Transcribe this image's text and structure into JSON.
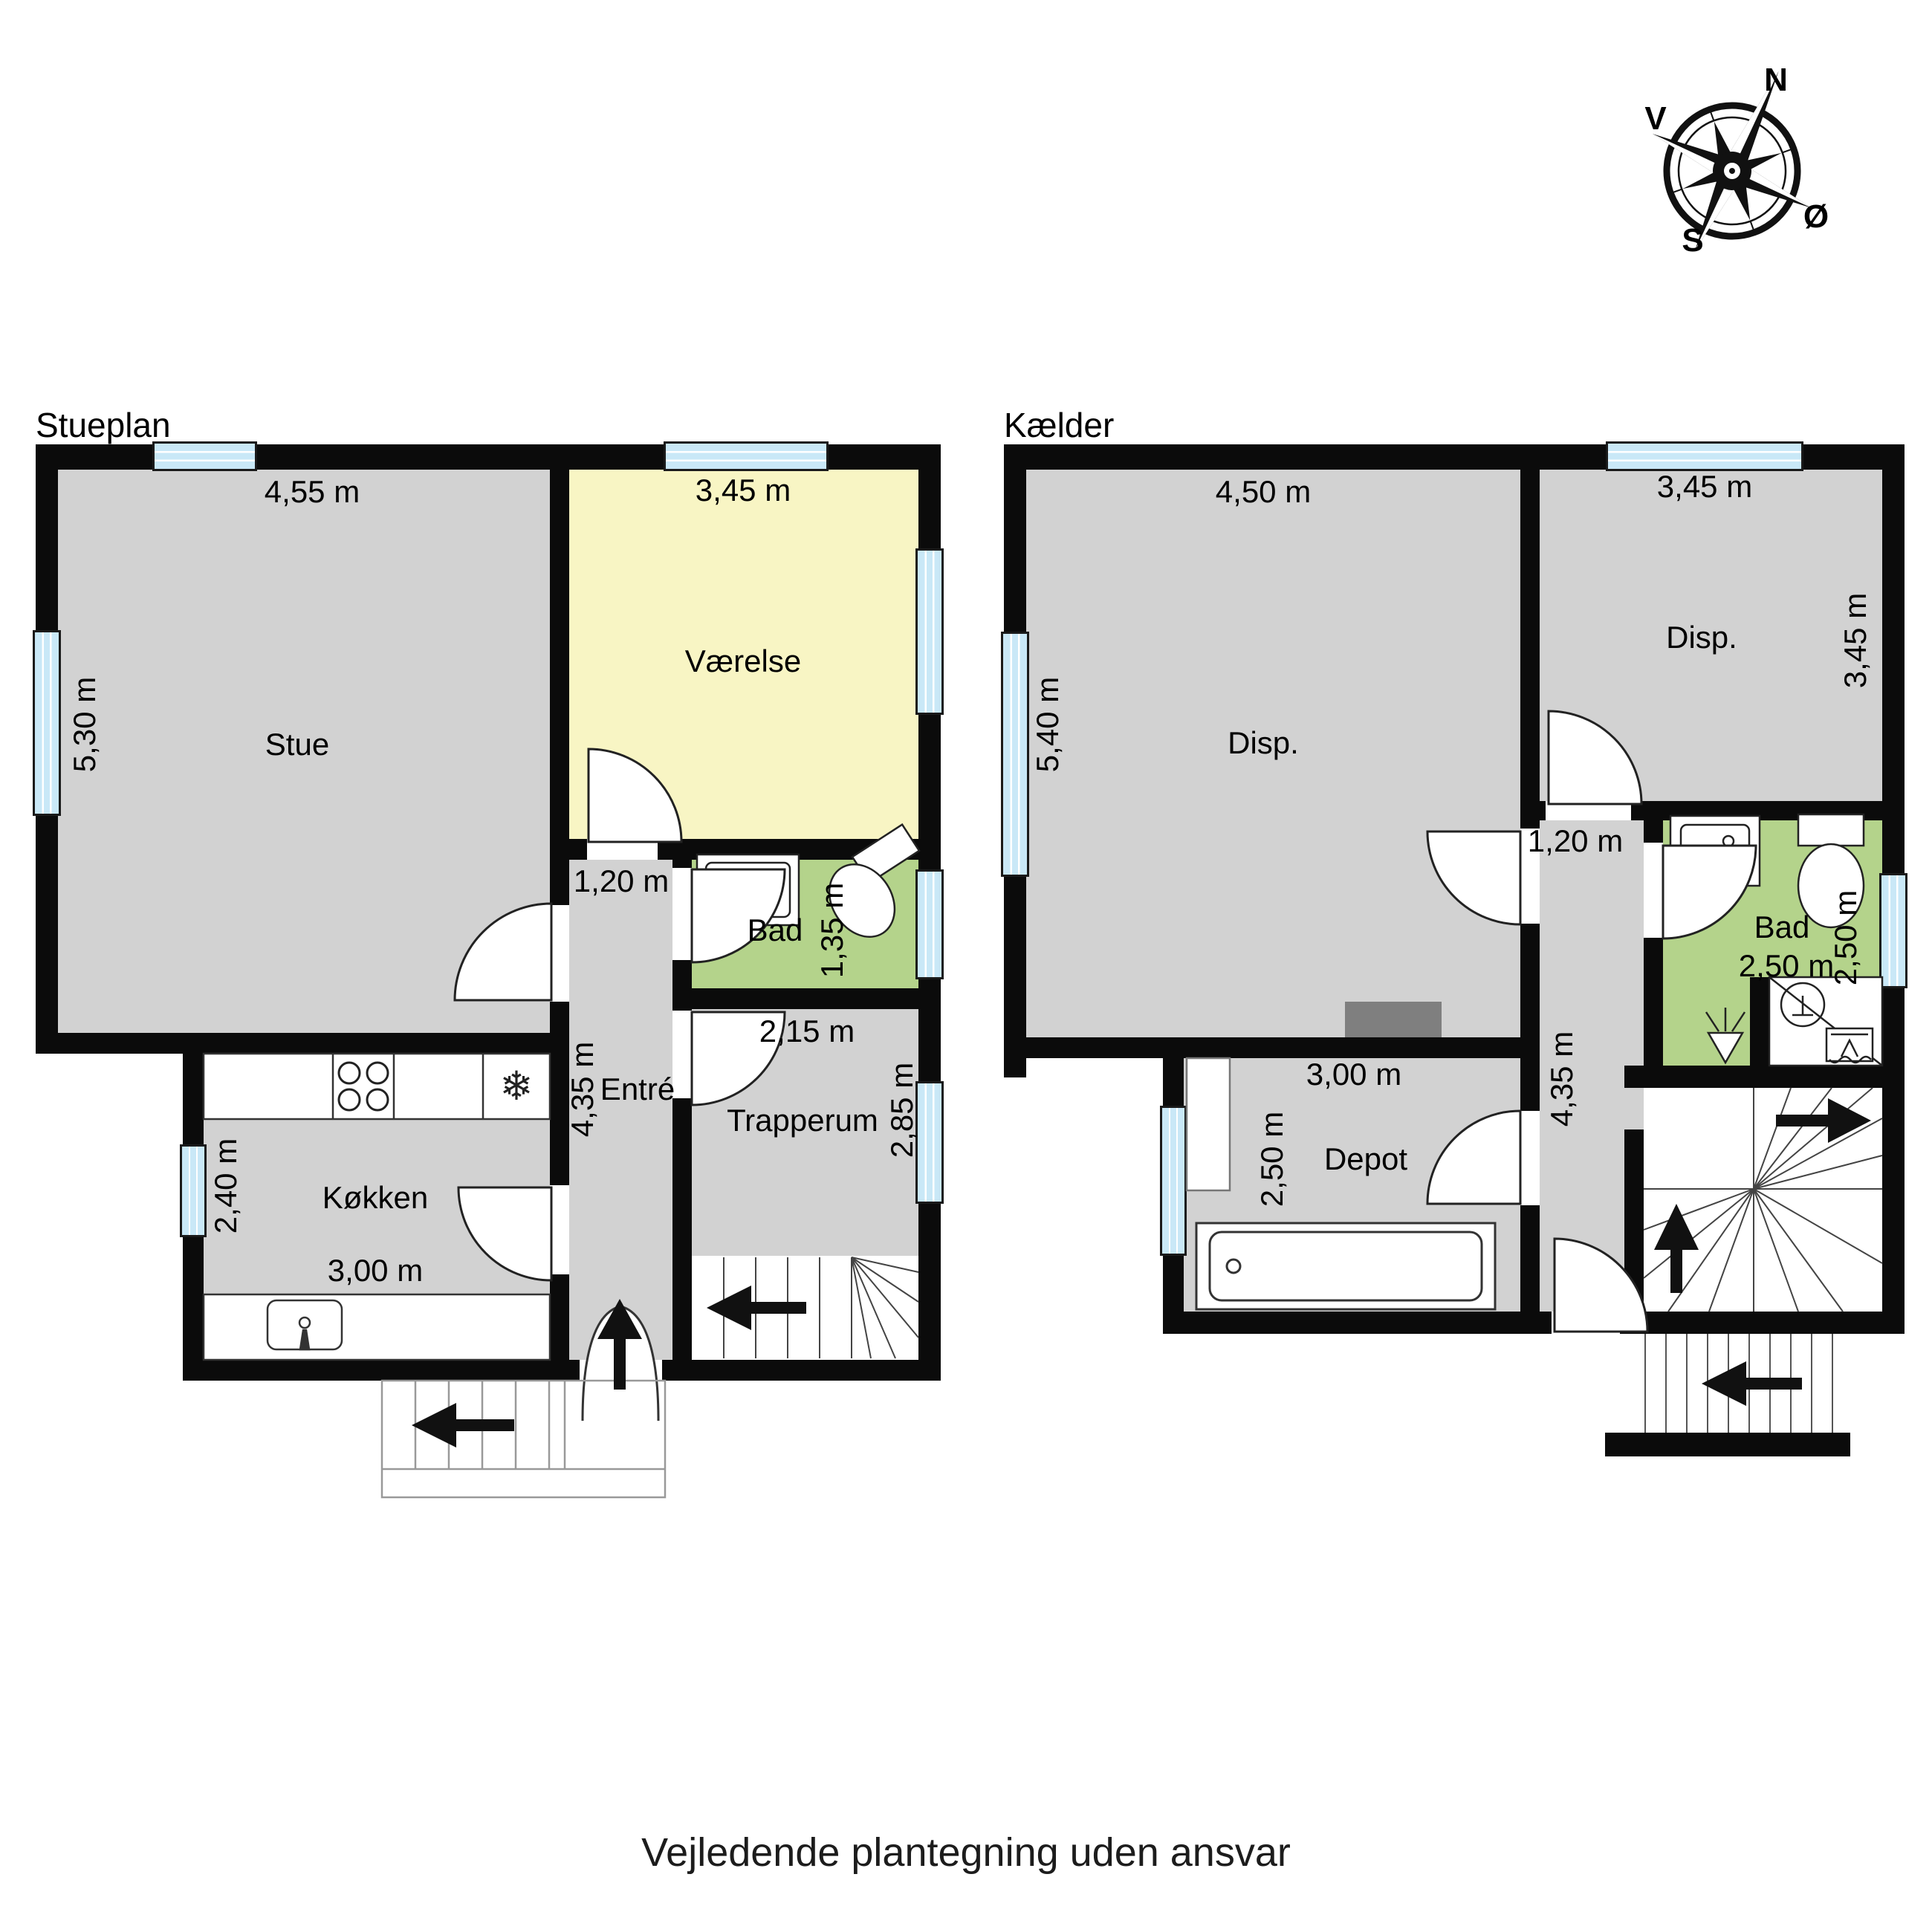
{
  "page": {
    "caption": "Vejledende plantegning uden ansvar"
  },
  "compass": {
    "n": "N",
    "e": "Ø",
    "s": "S",
    "w": "V"
  },
  "colors": {
    "wall": "#0b0b0b",
    "room_gray": "#d2d2d2",
    "room_yellow": "#f8f5c4",
    "room_green": "#b4d38b",
    "window_blue": "#c9e8f7",
    "chimney_gray": "#7f7f7f"
  },
  "stueplan": {
    "title": "Stueplan",
    "rooms": {
      "stue": "Stue",
      "vaerelse": "Værelse",
      "bad": "Bad",
      "entre": "Entré",
      "trapperum": "Trapperum",
      "koekken": "Køkken"
    },
    "dims": {
      "stue_w": "4,55 m",
      "vaerelse_w": "3,45 m",
      "stue_h": "5,30 m",
      "entre_w": "1,20 m",
      "bad_h": "1,35 m",
      "trapperum_w": "2,15 m",
      "entre_h": "4,35 m",
      "trapperum_h": "2,85 m",
      "koekken_h": "2,40 m",
      "koekken_w": "3,00 m"
    }
  },
  "kaelder": {
    "title": "Kælder",
    "rooms": {
      "disp_left": "Disp.",
      "disp_right": "Disp.",
      "bad": "Bad",
      "depot": "Depot"
    },
    "dims": {
      "disp_left_w": "4,50 m",
      "disp_right_w": "3,45 m",
      "disp_left_h": "5,40 m",
      "disp_right_h": "3,45 m",
      "hall_w": "1,20 m",
      "bad_w": "2,50 m",
      "bad_h": "2,50 m",
      "hall_h": "4,35 m",
      "depot_w": "3,00 m",
      "depot_h": "2,50 m"
    }
  }
}
